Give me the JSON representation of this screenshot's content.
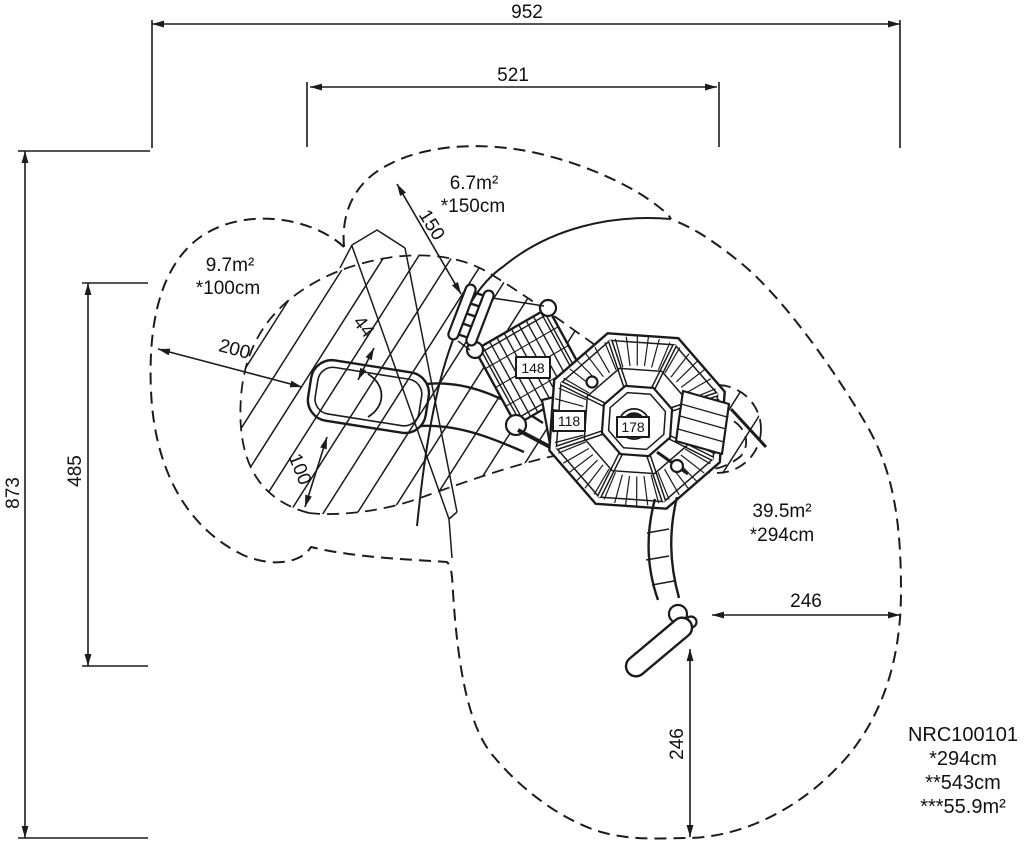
{
  "drawing": {
    "dimensions": {
      "top_total": "952",
      "top_inner": "521",
      "left_total": "873",
      "left_inner": "485",
      "right_offset": "246",
      "bottom_offset": "246",
      "zone_radius": "150",
      "bench_offset_left": "200",
      "bench_width": "44",
      "bench_offset_bottom": "100"
    },
    "zones": {
      "zone_top": {
        "area": "6.7m²",
        "radius": "*150cm"
      },
      "zone_left": {
        "area": "9.7m²",
        "radius": "*100cm"
      },
      "zone_right": {
        "area": "39.5m²",
        "radius": "*294cm"
      }
    },
    "parts": {
      "p148": "148",
      "p118": "118",
      "p178": "178"
    },
    "title_block": {
      "code": "NRC100101",
      "spec1": "*294cm",
      "spec2": "**543cm",
      "spec3": "***55.9m²"
    }
  }
}
